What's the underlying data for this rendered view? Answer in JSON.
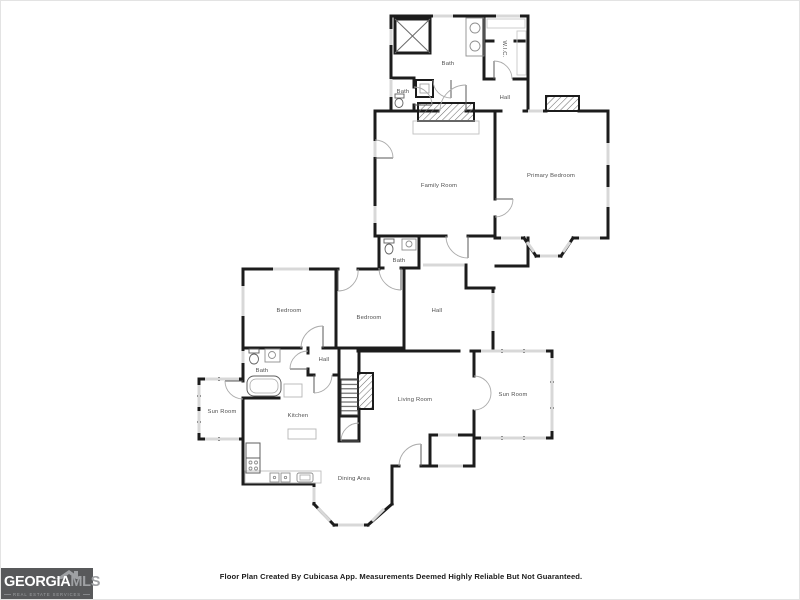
{
  "plan": {
    "rooms": [
      {
        "id": "bath-main",
        "label": "Bath"
      },
      {
        "id": "bath-upper",
        "label": "Bath"
      },
      {
        "id": "wic",
        "label": "W.I.C."
      },
      {
        "id": "hall-upper",
        "label": "Hall"
      },
      {
        "id": "family-room",
        "label": "Family Room"
      },
      {
        "id": "primary-bedroom",
        "label": "Primary Bedroom"
      },
      {
        "id": "bath-ensuite",
        "label": "Bath"
      },
      {
        "id": "bedroom-left",
        "label": "Bedroom"
      },
      {
        "id": "bedroom-middle",
        "label": "Bedroom"
      },
      {
        "id": "hall-middle",
        "label": "Hall"
      },
      {
        "id": "hall-lower",
        "label": "Hall"
      },
      {
        "id": "bath-lower",
        "label": "Bath"
      },
      {
        "id": "sun-room-left",
        "label": "Sun Room"
      },
      {
        "id": "kitchen",
        "label": "Kitchen"
      },
      {
        "id": "living-room",
        "label": "Living Room"
      },
      {
        "id": "sun-room-right",
        "label": "Sun Room"
      },
      {
        "id": "dining-area",
        "label": "Dining Area"
      }
    ],
    "colors": {
      "wall": "#1c1c1c",
      "window": "#d8d8d8",
      "door_arc": "#aaaaaa",
      "fixture_outline": "#8f8f8f",
      "room_label": "#4f4f4f"
    }
  },
  "footer": {
    "disclaimer": "Floor Plan Created By Cubicasa App. Measurements Deemed Highly Reliable But Not Guaranteed."
  },
  "logo": {
    "brand_primary": "GEORGIA",
    "brand_secondary": "MLS",
    "tagline": "REAL ESTATE SERVICES",
    "colors": {
      "background": "#58595b",
      "primary": "#ffffff",
      "secondary": "#9fa1a4"
    }
  }
}
